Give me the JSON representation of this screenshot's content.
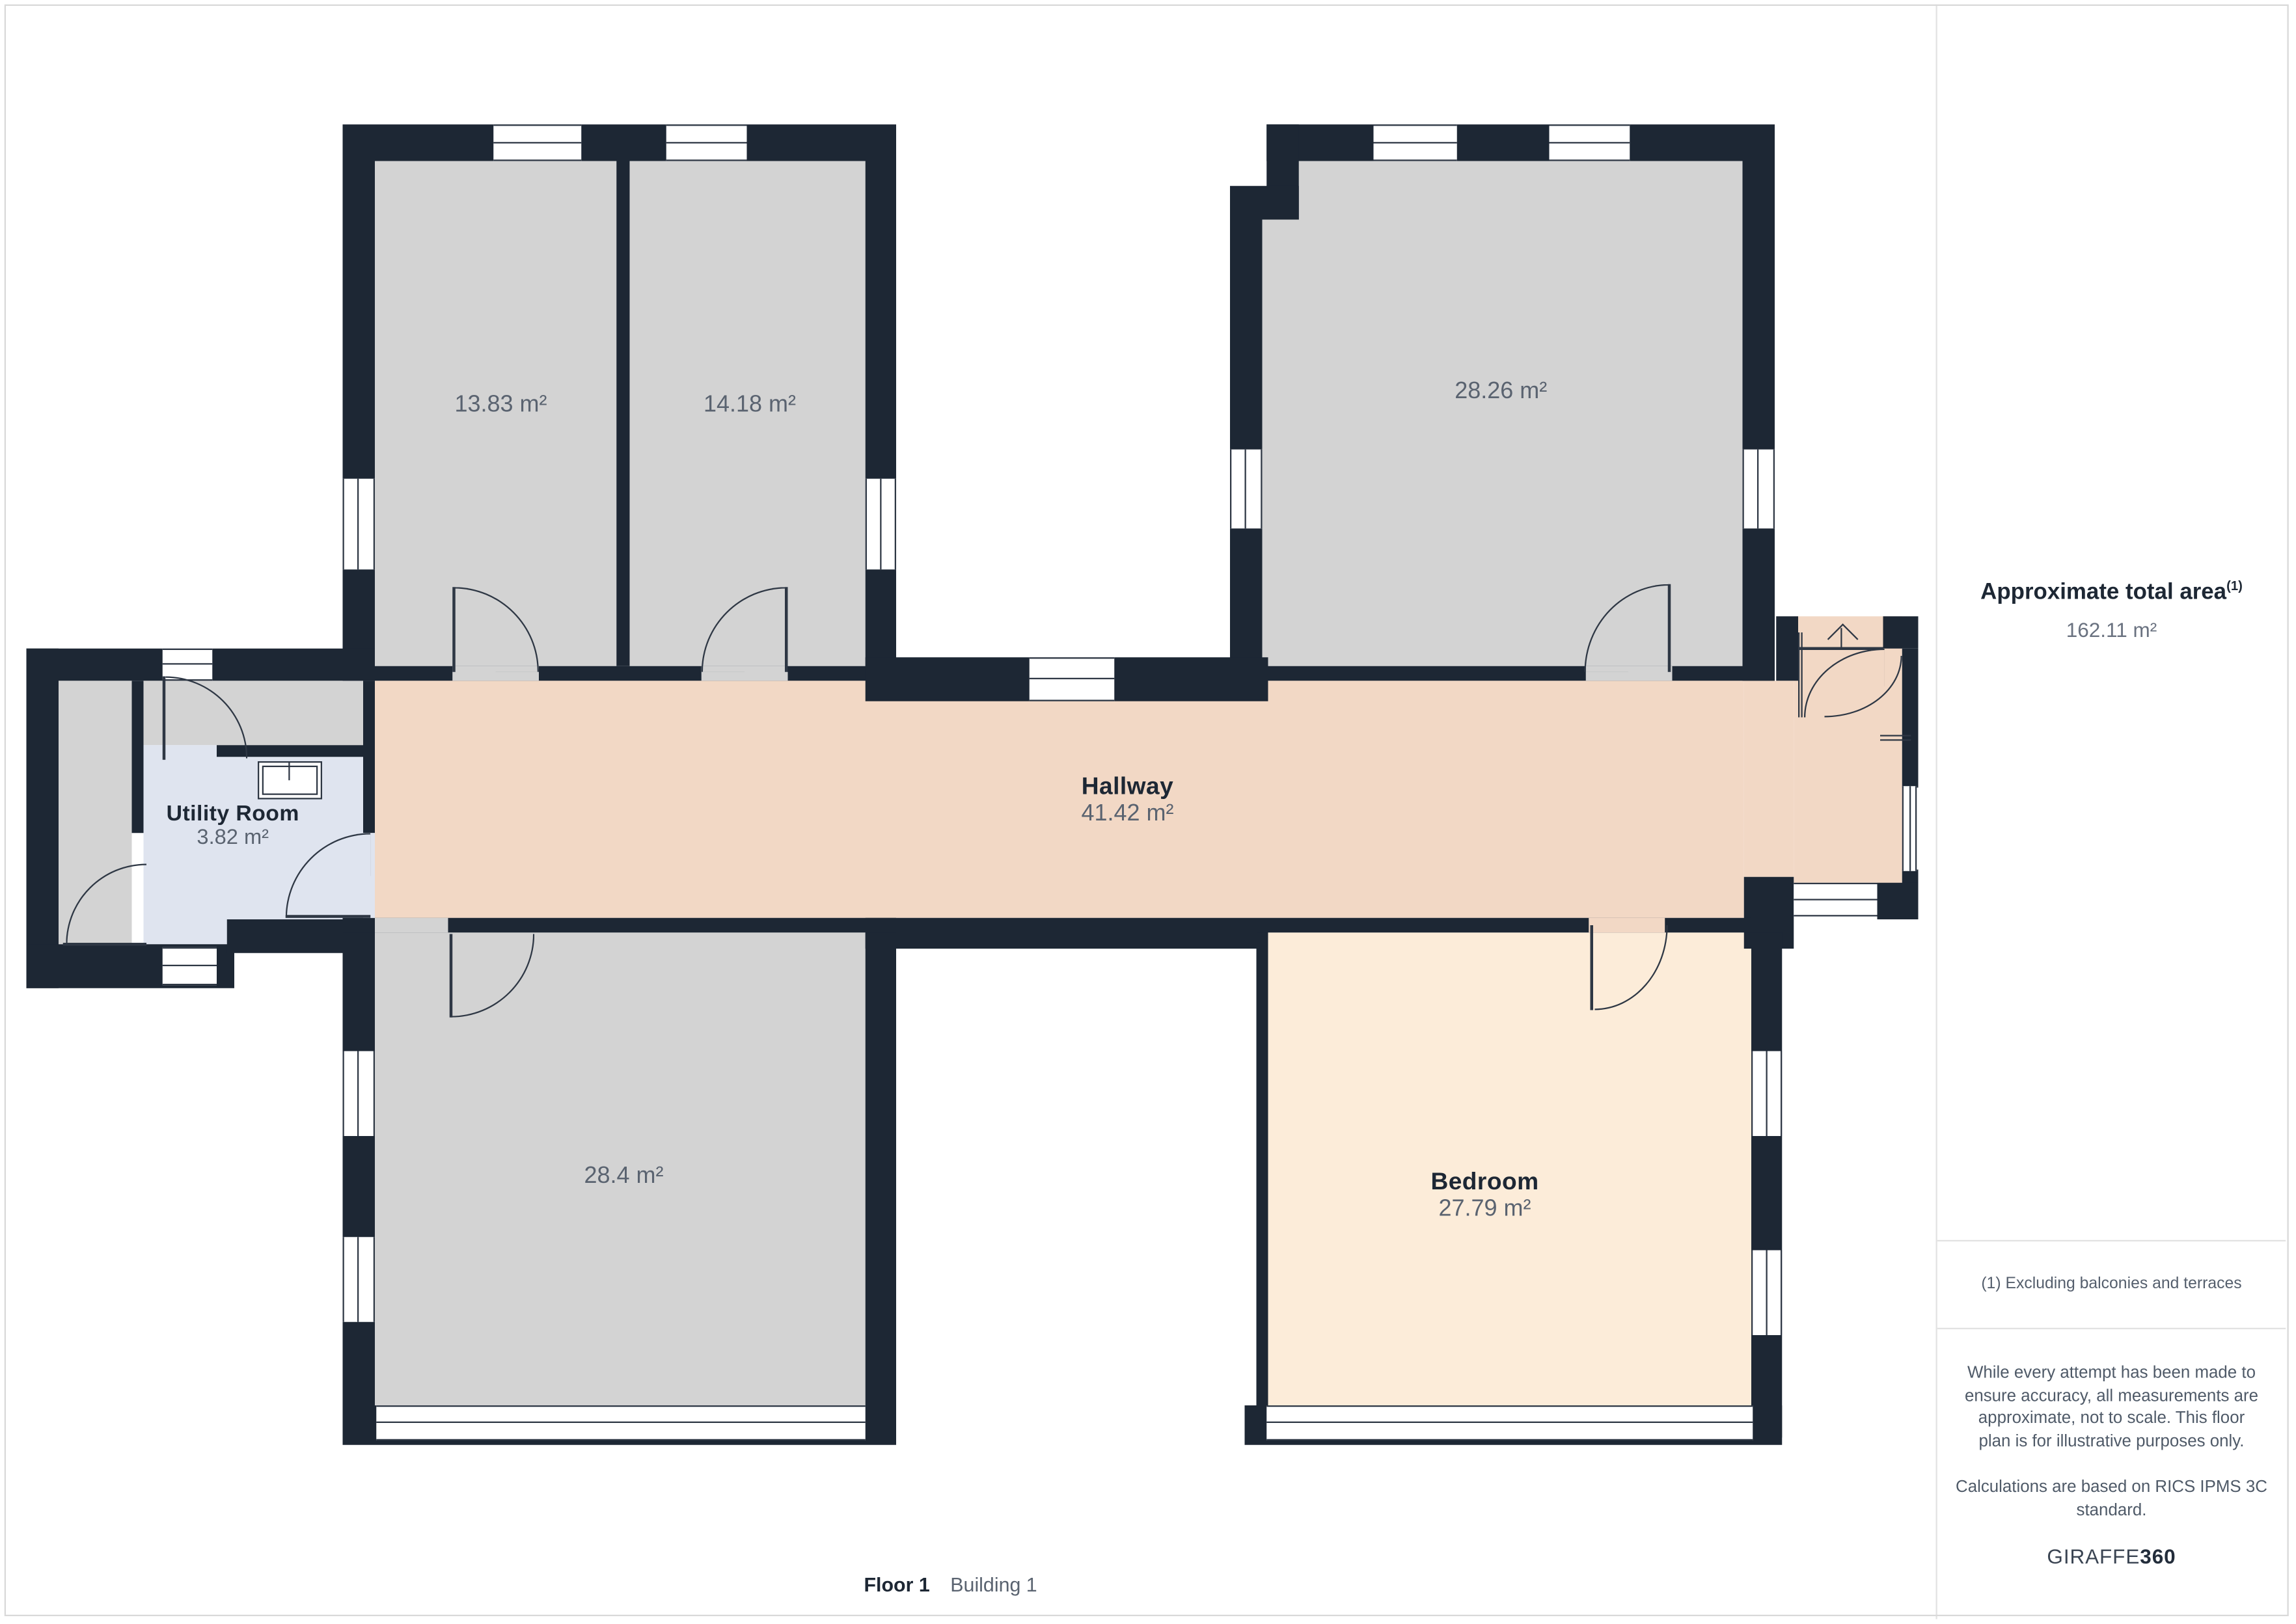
{
  "plan": {
    "rooms": [
      {
        "id": "room-13-83",
        "area": "13.83 m²"
      },
      {
        "id": "room-14-18",
        "area": "14.18 m²"
      },
      {
        "id": "room-28-26",
        "area": "28.26 m²"
      },
      {
        "id": "hallway",
        "name": "Hallway",
        "area": "41.42 m²"
      },
      {
        "id": "utility-room",
        "name": "Utility Room",
        "area": "3.82 m²"
      },
      {
        "id": "room-28-4",
        "area": "28.4 m²"
      },
      {
        "id": "bedroom",
        "name": "Bedroom",
        "area": "27.79 m²"
      }
    ],
    "icons": [
      {
        "name": "stairs-up-arrow-icon"
      },
      {
        "name": "sink-icon"
      }
    ]
  },
  "sidebar": {
    "title": "Approximate total area",
    "title_superscript": "(1)",
    "total_area": "162.11 m²",
    "footnote": "(1) Excluding balconies and terraces",
    "disclaimer_lines": [
      "While every attempt has been made to",
      "ensure accuracy, all measurements are",
      "approximate, not to scale. This floor",
      "plan is for illustrative purposes only."
    ],
    "standard_lines": [
      "Calculations are based on RICS IPMS 3C",
      "standard."
    ],
    "brand_name": "GIRAFFE",
    "brand_suffix": "360"
  },
  "footer": {
    "floor_label": "Floor 1",
    "building_label": "Building 1"
  },
  "colors": {
    "wall": "#1d2734",
    "gray": "#d3d3d3",
    "pink": "#f2d8c5",
    "peach": "#fcecd9",
    "blue": "#dfe4ef",
    "tdark": "#1d2734",
    "tgray": "#5a6370"
  }
}
